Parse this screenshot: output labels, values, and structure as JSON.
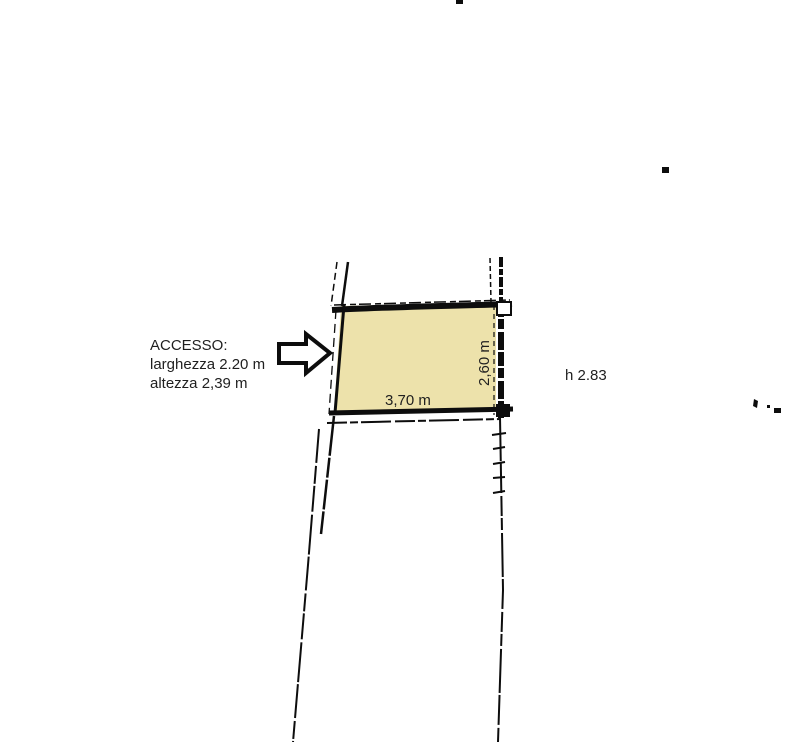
{
  "drawing": {
    "background_color": "#ffffff",
    "ink_color": "#0d0d0d",
    "text_color": "#1f1f1f",
    "access_note": {
      "title": "ACCESSO:",
      "width_line": "larghezza 2.20 m",
      "height_line": "altezza 2,39 m"
    },
    "room": {
      "fill_color": "#ede2ab",
      "width_label": "3,70 m",
      "depth_label": "2,60 m",
      "ceiling_height_label": "h 2.83"
    }
  }
}
